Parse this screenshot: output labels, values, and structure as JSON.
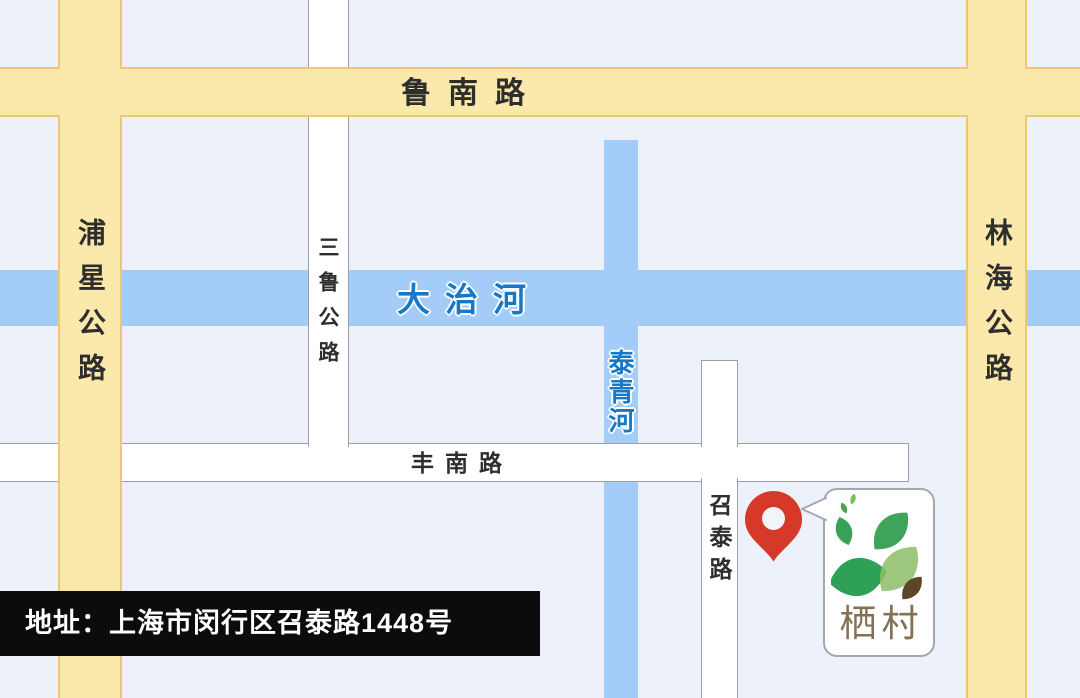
{
  "map": {
    "background": "#edf1f9",
    "roads": {
      "lunan": {
        "name": "鲁南路"
      },
      "puxing": {
        "name": "浦星公路"
      },
      "linhai": {
        "name": "林海公路"
      },
      "sanlu": {
        "name": "三鲁公路"
      },
      "fengnan": {
        "name": "丰南路"
      },
      "zhaotai": {
        "name": "召泰路"
      }
    },
    "rivers": {
      "dazhi": {
        "name": "大治河"
      },
      "taiqing": {
        "name": "泰青河"
      }
    },
    "colors": {
      "highway_fill": "#fbe9ab",
      "highway_border": "#edc775",
      "street_fill": "#ffffff",
      "street_border": "#9aa0a6",
      "river_fill": "#a4ccf9",
      "river_label": "#1778c8",
      "marker_red": "#d6382a",
      "leaf_green": "#3aa257",
      "leaf_light_green": "#8cbd69",
      "leaf_brown": "#5d4528",
      "logo_text_color": "#837154"
    }
  },
  "marker": {
    "icon": "location-pin"
  },
  "logo_card": {
    "text": "栖村"
  },
  "address_bar": {
    "text": "地址：上海市闵行区召泰路1448号"
  }
}
